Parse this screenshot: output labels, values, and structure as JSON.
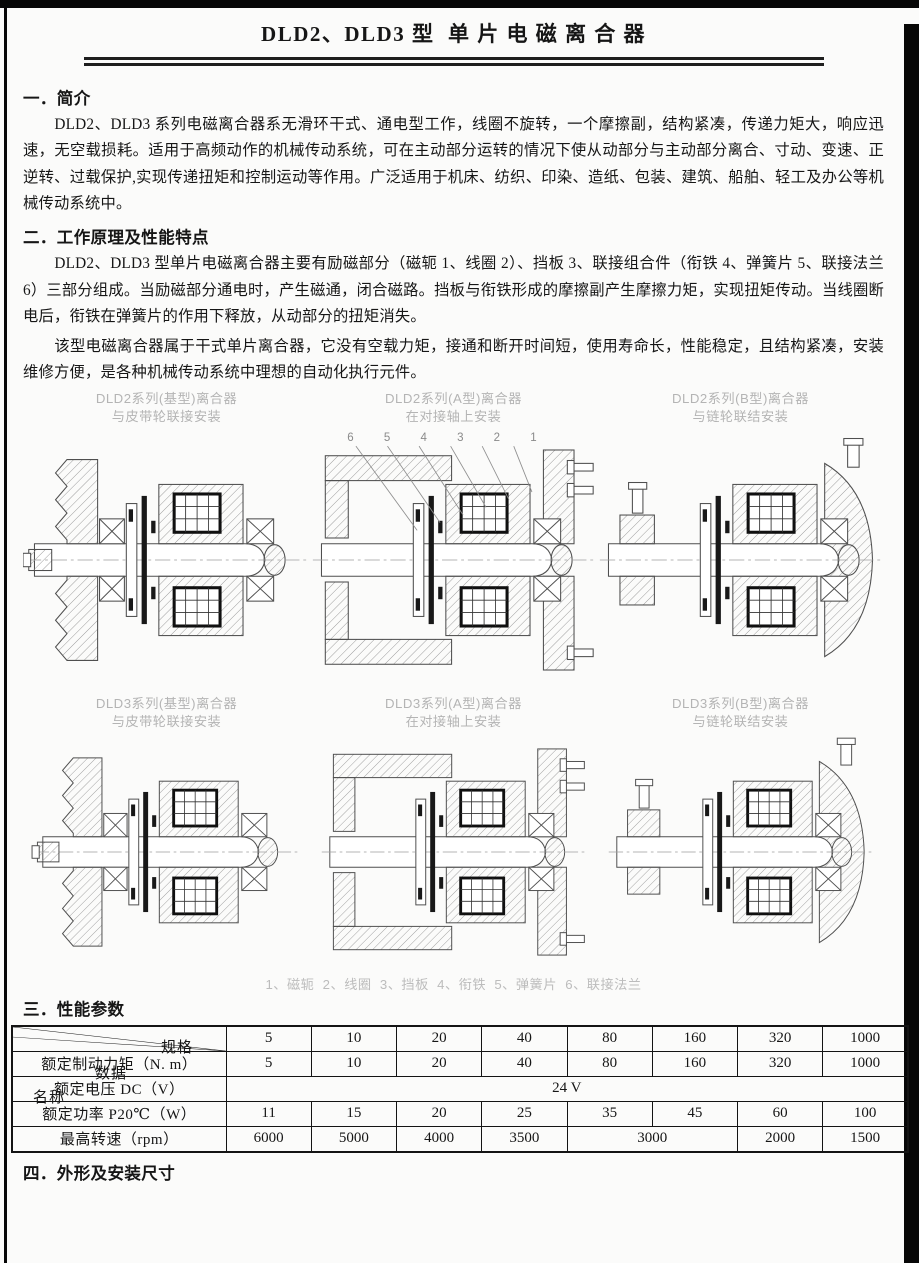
{
  "title": "DLD2、DLD3 型  单 片 电 磁 离 合 器",
  "sections": {
    "s1": {
      "heading": "一．简介",
      "p1": "DLD2、DLD3 系列电磁离合器系无滑环干式、通电型工作，线圈不旋转，一个摩擦副，结构紧凑，传递力矩大，响应迅速，无空载损耗。适用于高频动作的机械传动系统，可在主动部分运转的情况下使从动部分与主动部分离合、寸动、变速、正逆转、过载保护,实现传递扭矩和控制运动等作用。广泛适用于机床、纺织、印染、造纸、包装、建筑、船舶、轻工及办公等机械传动系统中。"
    },
    "s2": {
      "heading": "二．工作原理及性能特点",
      "p1": "DLD2、DLD3 型单片电磁离合器主要有励磁部分（磁轭 1、线圈 2）、挡板 3、联接组合件（衔铁 4、弹簧片 5、联接法兰 6）三部分组成。当励磁部分通电时，产生磁通，闭合磁路。挡板与衔铁形成的摩擦副产生摩擦力矩，实现扭矩传动。当线圈断电后，衔铁在弹簧片的作用下释放，从动部分的扭矩消失。",
      "p2": "该型电磁离合器属于干式单片离合器，它没有空载力矩，接通和断开时间短，使用寿命长，性能稳定，且结构紧凑，安装维修方便，是各种机械传动系统中理想的自动化执行元件。"
    },
    "s3": {
      "heading": "三．性能参数"
    },
    "s4": {
      "heading": "四．外形及安装尺寸"
    }
  },
  "figures": [
    {
      "caption_line1": "DLD2系列(基型)离合器",
      "caption_line2": "与皮带轮联接安装"
    },
    {
      "caption_line1": "DLD2系列(A型)离合器",
      "caption_line2": "在对接轴上安装"
    },
    {
      "caption_line1": "DLD2系列(B型)离合器",
      "caption_line2": "与链轮联结安装"
    },
    {
      "caption_line1": "DLD3系列(基型)离合器",
      "caption_line2": "与皮带轮联接安装"
    },
    {
      "caption_line1": "DLD3系列(A型)离合器",
      "caption_line2": "在对接轴上安装"
    },
    {
      "caption_line1": "DLD3系列(B型)离合器",
      "caption_line2": "与链轮联结安装"
    }
  ],
  "part_numbers": [
    "6",
    "5",
    "4",
    "3",
    "2",
    "1"
  ],
  "figure_legend": "1、磁轭  2、线圈  3、挡板  4、衔铁  5、弹簧片  6、联接法兰",
  "table": {
    "corner": {
      "spec": "规格",
      "data": "数据",
      "name": "名称"
    },
    "spec_columns": [
      "5",
      "10",
      "20",
      "40",
      "80",
      "160",
      "320",
      "1000"
    ],
    "rows": [
      {
        "label": "额定制动力矩（N. m）",
        "values": [
          "5",
          "10",
          "20",
          "40",
          "80",
          "160",
          "320",
          "1000"
        ]
      },
      {
        "label": "额定电压 DC（V）",
        "values": [
          "24 V"
        ]
      },
      {
        "label": "额定功率 P20℃（W）",
        "values": [
          "11",
          "15",
          "20",
          "25",
          "35",
          "45",
          "60",
          "100"
        ]
      },
      {
        "label": "最高转速（rpm）",
        "values": [
          "6000",
          "5000",
          "4000",
          "3500",
          "3000",
          "2000",
          "1500"
        ]
      }
    ]
  }
}
